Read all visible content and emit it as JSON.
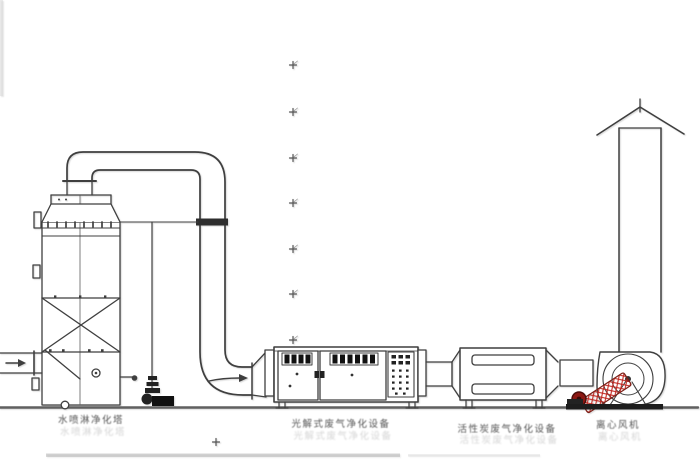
{
  "diagram": {
    "labels": {
      "tower": "水喷淋净化塔",
      "uv_unit": "光解式废气净化设备",
      "carbon_unit": "活性炭废气净化设备",
      "fan": "离心风机"
    },
    "colors": {
      "line": "#3f3f3f",
      "ground": "#606060",
      "motor_red": "#c0261f",
      "motor_cap": "#8c1712",
      "louver_slot": "#111111"
    },
    "icons": {
      "inlet_flow_arrow": "right-arrow",
      "duct_flow_arrow": "right-arrow",
      "centerline_mark": "plus-tick"
    }
  }
}
